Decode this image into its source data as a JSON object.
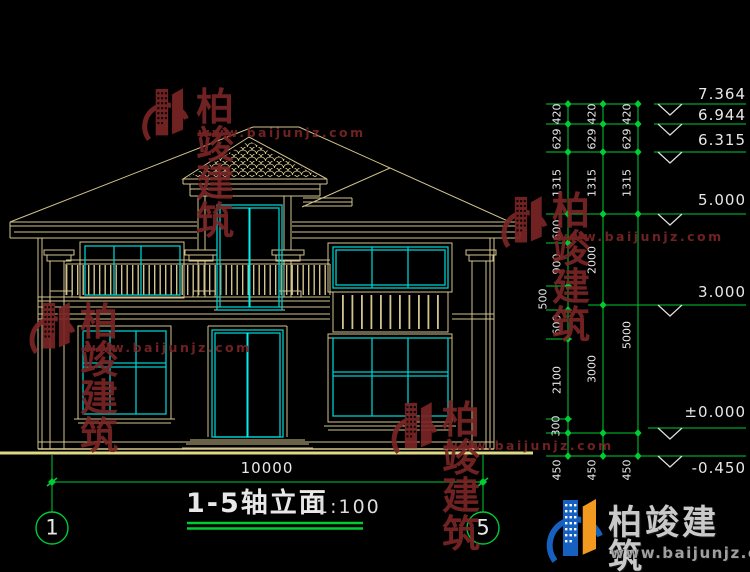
{
  "drawing": {
    "title": "1-5轴立面",
    "scale": "1:100",
    "overall_width_dim": "10000",
    "axis_left": "1",
    "axis_right": "5",
    "elevation_marks": [
      "7.364",
      "6.944",
      "6.315",
      "5.000",
      "3.000",
      "±0.000",
      "-0.450"
    ],
    "dim_chains": {
      "col1": [
        "420",
        "629",
        "1315",
        "600",
        "900",
        "500",
        "600",
        "2100",
        "300",
        "450"
      ],
      "col2": [
        "420",
        "629",
        "1315",
        "2000",
        "3000",
        "450"
      ],
      "col3": [
        "420",
        "629",
        "1315",
        "5000",
        "450"
      ]
    },
    "colors": {
      "line_tan": "#d2c48c",
      "line_cyan": "#00cccc",
      "line_green": "#00cc33",
      "ground_yellow": "#ded982",
      "watermark_red": "#7a2525"
    }
  },
  "watermark": {
    "brand": "柏竣建筑",
    "url": "www.baijunjz.com"
  },
  "footer_logo": {
    "brand": "柏竣建筑",
    "url": "www.baijunjz.com"
  }
}
